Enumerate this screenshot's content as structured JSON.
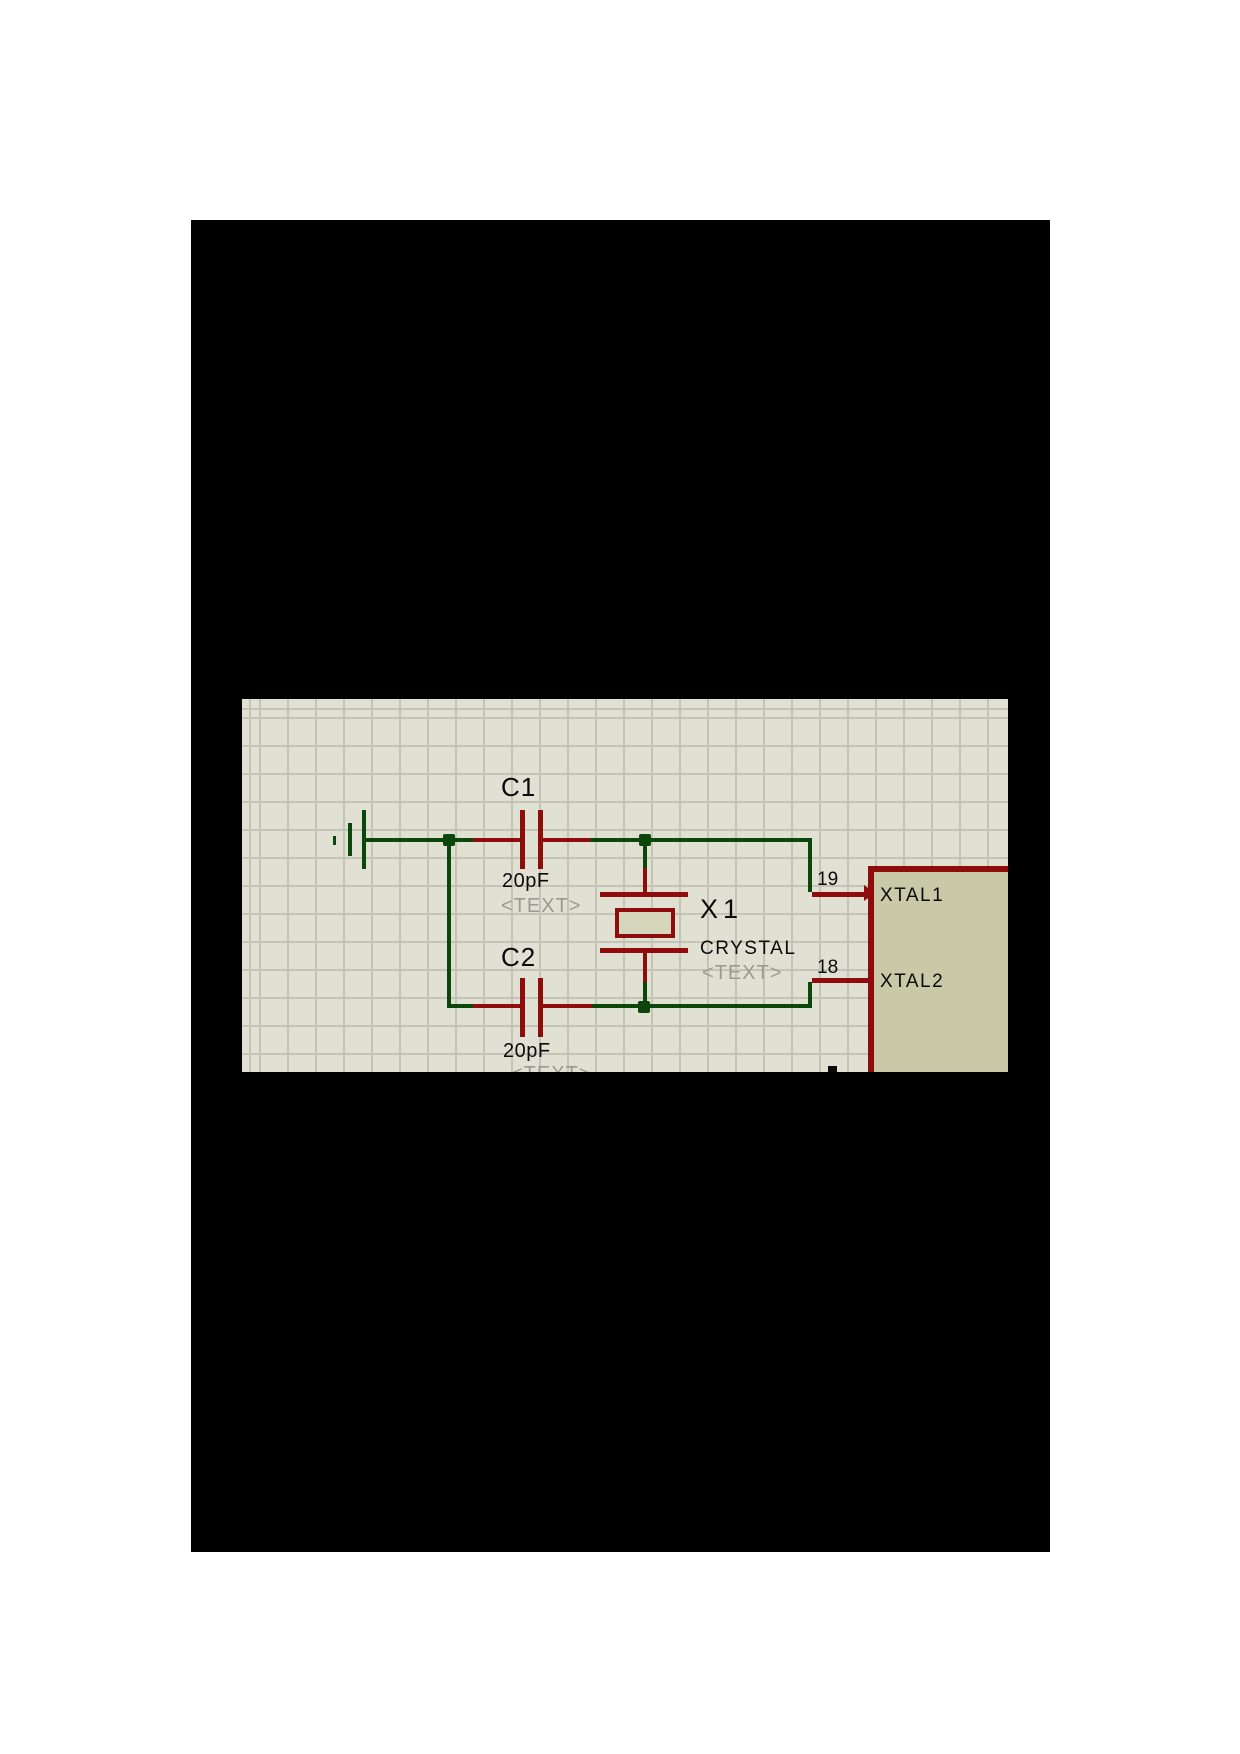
{
  "page": {
    "canvas_color": "#ffffff",
    "slide_color": "#000000"
  },
  "schematic": {
    "colors": {
      "grid_bg": "#e1e1d3",
      "grid_line": "#c4c4b6",
      "wire_green": "#0b470b",
      "component_red": "#8e0c0c",
      "chip_fill": "#c9c9a7",
      "crystal_fill": "#d6d6bc",
      "text_black": "#0a0a0a",
      "text_gray": "#9a9a92"
    },
    "components": [
      {
        "ref": "C1",
        "value": "20pF",
        "placeholder": "<TEXT>"
      },
      {
        "ref": "C2",
        "value": "20pF",
        "placeholder": "<TEXT>"
      },
      {
        "ref": "X1",
        "value": "CRYSTAL",
        "placeholder": "<TEXT>"
      }
    ],
    "chip": {
      "pins": [
        {
          "number": "19",
          "name": "XTAL1"
        },
        {
          "number": "18",
          "name": "XTAL2"
        }
      ]
    }
  }
}
